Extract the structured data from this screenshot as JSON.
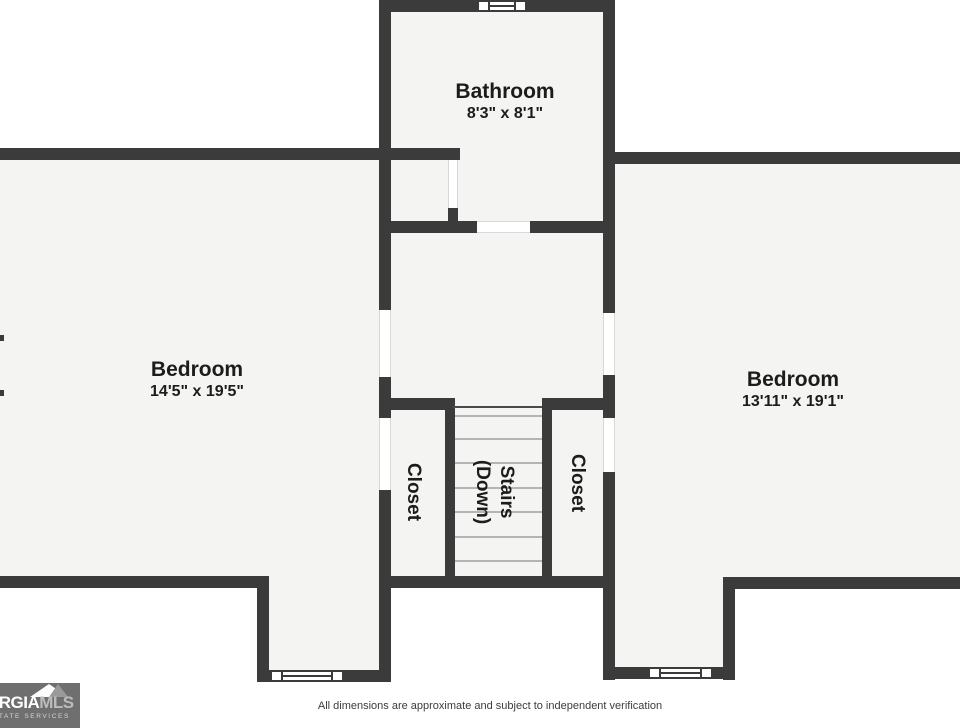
{
  "rooms": {
    "bathroom": {
      "label": "Bathroom",
      "dims": "8'3\" x 8'1\""
    },
    "bedroom_left": {
      "label": "Bedroom",
      "dims": "14'5\" x 19'5\""
    },
    "bedroom_right": {
      "label": "Bedroom",
      "dims": "13'11\" x 19'1\""
    },
    "closet_left": {
      "label": "Closet"
    },
    "closet_right": {
      "label": "Closet"
    },
    "stairs": {
      "line1": "Stairs",
      "line2": "(Down)"
    }
  },
  "watermark": {
    "name_fragment": "ORGIA",
    "name_suffix": "MLS",
    "subtitle": "ESTATE SERVICES"
  },
  "footer": {
    "disclaimer": "All dimensions are approximate and subject to independent verification"
  },
  "colors": {
    "wall": "#3b3b3b",
    "room_fill": "#f4f4f3",
    "outside": "#ffffff",
    "tread": "#b4b4b4",
    "watermark_bg": "#6f6f6f"
  }
}
